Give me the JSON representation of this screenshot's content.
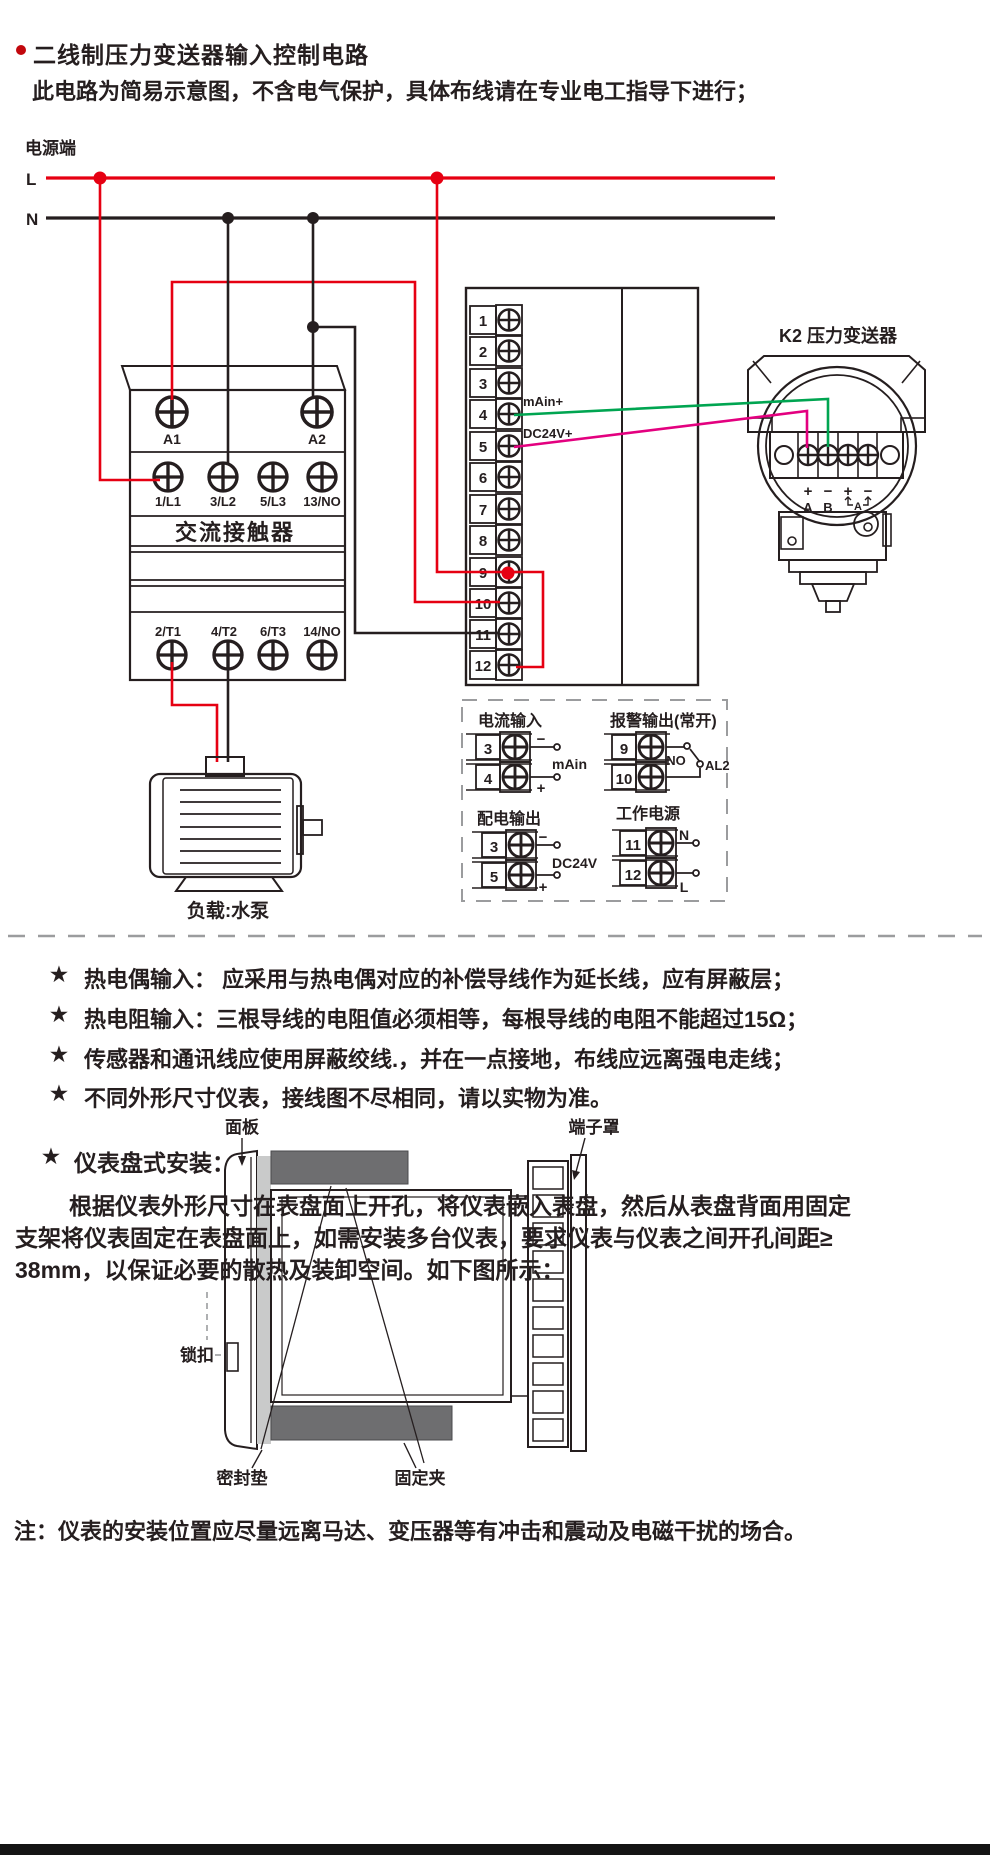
{
  "header": {
    "title": "二线制压力变送器输入控制电路",
    "subtitle": "此电路为简易示意图，不含电气保护，具体布线请在专业电工指导下进行；"
  },
  "colors": {
    "wire_red": "#e60012",
    "wire_black": "#251e1f",
    "wire_green": "#00a551",
    "wire_magenta": "#e3007f",
    "panel_gray": "#c9caca",
    "clip_gray": "#6e6e70"
  },
  "power": {
    "label": "电源端",
    "line_l": "L",
    "line_n": "N"
  },
  "contactor": {
    "name": "交流接触器",
    "coil": [
      "A1",
      "A2"
    ],
    "input": [
      "1/L1",
      "3/L2",
      "5/L3",
      "13/NO"
    ],
    "output": [
      "2/T1",
      "4/T2",
      "6/T3",
      "14/NO"
    ]
  },
  "instrument": {
    "terminals": [
      "1",
      "2",
      "3",
      "4",
      "5",
      "6",
      "7",
      "8",
      "9",
      "10",
      "11",
      "12"
    ],
    "main_label": "mAin+",
    "dc_label": "DC24V+"
  },
  "transmitter": {
    "title": "K2  压力变送器",
    "polarity": [
      "+",
      "−",
      "+",
      "−"
    ],
    "wires": [
      "A",
      "B"
    ],
    "bracket": "A"
  },
  "motor": {
    "caption": "负载:水泵"
  },
  "panels": {
    "current_input": {
      "title": "电流输入",
      "t1": "3",
      "t2": "4",
      "minus": "−",
      "plus": "+",
      "caption": "mAin"
    },
    "alarm_output": {
      "title": "报警输出(常开)",
      "t1": "9",
      "t2": "10",
      "no": "NO",
      "al2": "AL2"
    },
    "dist_output": {
      "title": "配电输出",
      "t1": "3",
      "t2": "5",
      "minus": "−",
      "plus": "+",
      "caption": "DC24V"
    },
    "work_power": {
      "title": "工作电源",
      "t1": "11",
      "t2": "12",
      "n": "N",
      "l": "L"
    }
  },
  "bullets": {
    "star": "★",
    "items": [
      "热电偶输入： 应采用与热电偶对应的补偿导线作为延长线，应有屏蔽层；",
      "热电阻输入：三根导线的电阻值必须相等，每根导线的电阻不能超过15Ω；",
      "传感器和通讯线应使用屏蔽绞线.，并在一点接地，布线应远离强电走线；",
      "不同外形尺寸仪表，接线图不尽相同，请以实物为准。"
    ]
  },
  "install": {
    "star": "★",
    "heading": "仪表盘式安装：",
    "paragraph_lines": [
      "根据仪表外形尺寸在表盘面上开孔，将仪表嵌入表盘，然后从表盘背面用固定",
      "支架将仪表固定在表盘面上，如需安装多台仪表，要求仪表与仪表之间开孔间距≥",
      "38mm，以保证必要的散热及装卸空间。如下图所示："
    ],
    "labels": {
      "panel": "面板",
      "cover": "端子罩",
      "lock": "锁扣",
      "gasket": "密封垫",
      "clip": "固定夹"
    }
  },
  "footer": {
    "note": "注：仪表的安装位置应尽量远离马达、变压器等有冲击和震动及电磁干扰的场合。"
  }
}
